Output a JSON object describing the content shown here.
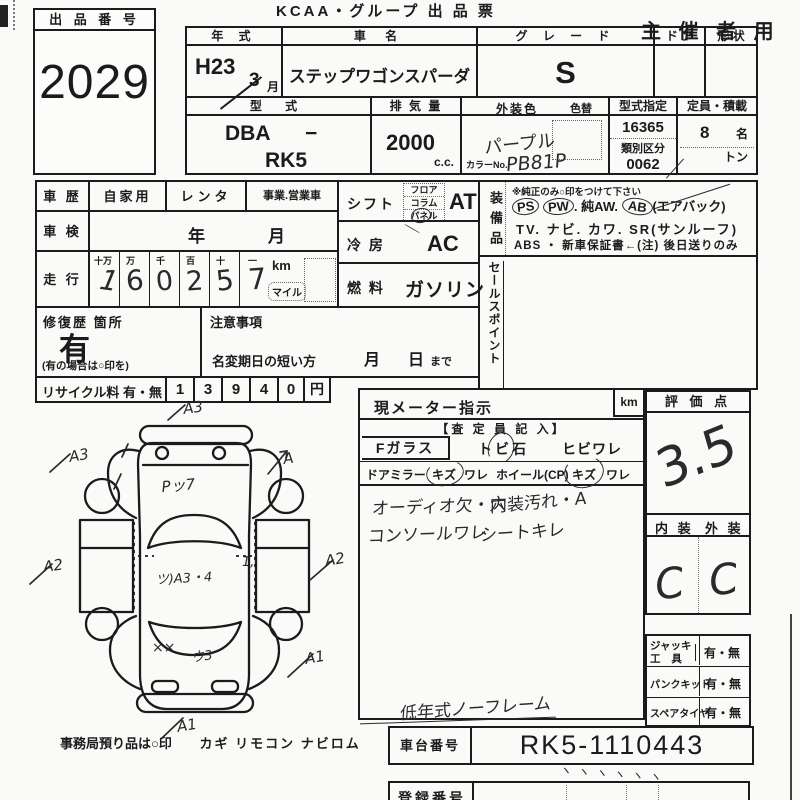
{
  "colors": {
    "paper": "#fafaf8",
    "ink": "#1b1b1b",
    "hand": "#2a2a2a"
  },
  "header": {
    "lot_label": "出 品 番 号",
    "lot_number": "2029",
    "title": "KCAA・グループ 出 品 票",
    "corner": "主 催 者 用"
  },
  "top": {
    "year_label": "年  式",
    "year": "H23",
    "month": "3",
    "month_unit": "月",
    "name_label": "車  名",
    "name": "ステップワゴンスパーダ",
    "grade_label": "グ レ ー ド",
    "grade": "S",
    "door_label": "ド ア",
    "shape_label": "形 状",
    "model_label": "型  式",
    "model_p1": "DBA",
    "model_dash": "−",
    "model_p2": "RK5",
    "disp_label": "排 気 量",
    "disp": "2000",
    "disp_unit": "c.c.",
    "color_label": "外装色",
    "color_change_label": "色替",
    "color": "パープル",
    "color_no_label": "カラーNo.",
    "color_no": "PB81P",
    "type_cert_label": "型式指定",
    "type_cert": "16365",
    "class_label": "類別区分",
    "class_no": "0062",
    "cap_label": "定員・積載",
    "cap_value": "8",
    "cap_unit": "名",
    "cap_ton": "トン"
  },
  "left": {
    "history_label": "車  歴",
    "history_opt1": "自家用",
    "history_opt2": "レンタ",
    "history_opt3": "事業.営業車",
    "shaken_label": "車  検",
    "shaken_year": "年",
    "shaken_month": "月",
    "run_label": "走  行",
    "run_cols": [
      "十万",
      "万",
      "千",
      "百",
      "十",
      "一"
    ],
    "run_digits": [
      "1",
      "6",
      "0",
      "2",
      "5",
      "7"
    ],
    "run_km": "km",
    "run_mile": "マイル",
    "repair_label": "修復歴 箇所",
    "repair_value": "有",
    "repair_note": "(有の場合は○印を)",
    "caution_label": "注意事項",
    "rename_label": "名変期日の短い方",
    "rename_month": "月",
    "rename_day": "日",
    "rename_made": "まで",
    "recycle_label": "リサイクル料 有・無",
    "recycle_digits": [
      "1",
      "3",
      "9",
      "4",
      "0"
    ],
    "recycle_unit": "円"
  },
  "mid": {
    "shift_label": "シフト",
    "shift_opts": [
      "フロア",
      "コラム",
      "パネル"
    ],
    "shift_value": "AT",
    "ac_label": "冷 房",
    "ac_value": "AC",
    "fuel_label": "燃 料",
    "fuel_value": "ガソリン",
    "equip_label": "装備品",
    "equip_note": "※純正のみ○印をつけて下さい",
    "equip_ps": "PS",
    "equip_pw": "PW",
    "equip_aw": ". 純AW.",
    "equip_ab": "AB",
    "equip_ab_note": "(エアバック)",
    "equip_line2": "TV. ナビ. カワ. SR(サンルーフ)",
    "equip_line3": "ABS ・ 新車保証書←(注) 後日送りのみ",
    "sales_label": "セールスポイント"
  },
  "meter": {
    "title": "現メーター指示",
    "unit": "km",
    "sub": "【査 定 員 記 入】",
    "fglass_label": "Fガラス",
    "fglass_opt1": "トビ石",
    "fglass_opt2": "ヒビワレ",
    "mirror_label": "ドアミラー",
    "mirror_opt1": "キズ",
    "mirror_opt2": "ワレ",
    "wheel_label": "ホイール(CP)",
    "wheel_opt1": "キズ",
    "wheel_opt2": "ワレ",
    "note1": "オーディオ欠・穴",
    "note2": "内装汚れ・A",
    "note3": "コンソールワレ",
    "note4": "シートキレ",
    "bottom_note": "低年式ノーフレーム"
  },
  "rating": {
    "label": "評 価 点",
    "score": "3.5",
    "int_label": "内 装",
    "ext_label": "外 装",
    "int_value": "C",
    "ext_value": "C"
  },
  "tools": {
    "jack_label1": "ジャッキ",
    "jack_label2": "工  具",
    "jack_value": "有・無",
    "pank_label": "パンクキット",
    "pank_value": "有・無",
    "spare_label": "スペアタイヤ",
    "spare_value": "有・無"
  },
  "chassis": {
    "label": "車台番号",
    "value": "RK5-1110443"
  },
  "reg": {
    "label": "登録番号",
    "ticks": "ヽヽヽヽヽヽ"
  },
  "office": {
    "label": "事務局預り品は○印",
    "items": "カギ  リモコン  ナビロム"
  },
  "diagram": {
    "front": "A3",
    "front_left": "A3",
    "front_right": "A",
    "left": "A2",
    "right": "A2",
    "rear_right": "A1",
    "rear": "A1",
    "hood": "Pッ7",
    "roof": "ツ)A3・4",
    "rear_mark": "××",
    "rear_mark2": "ウ3",
    "door_mark": "1,"
  }
}
